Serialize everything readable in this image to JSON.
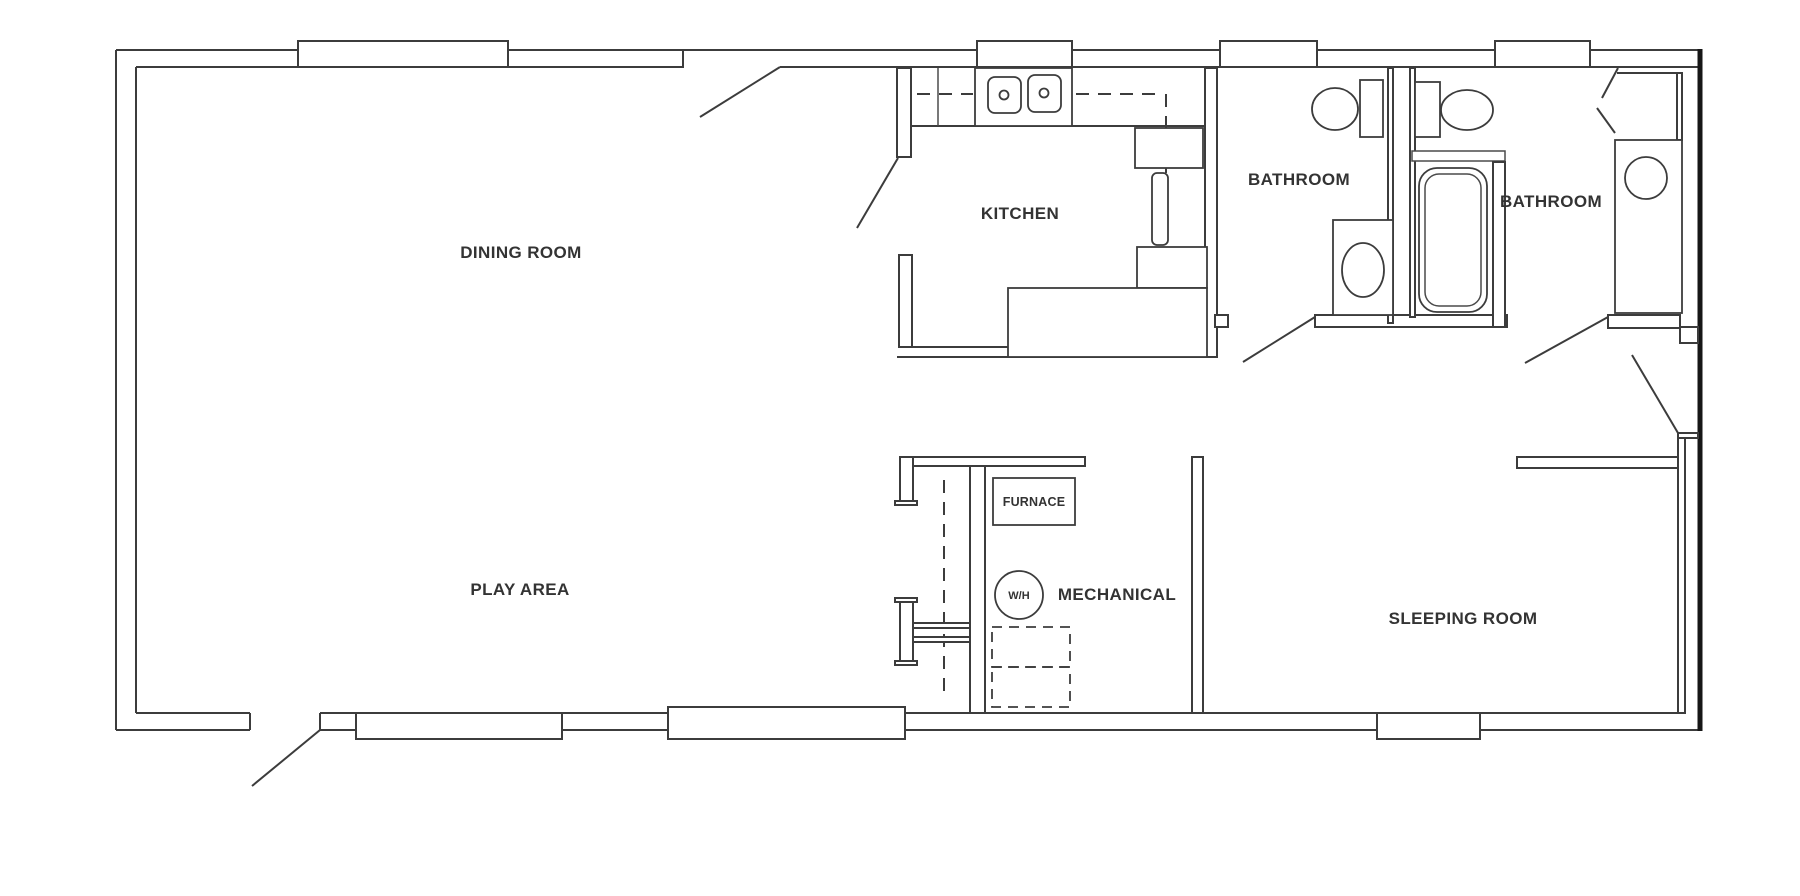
{
  "page": {
    "background": "#ffffff",
    "wall_color": "#3c3c3c",
    "outer_right_wall_color": "#161616",
    "label_color": "#333333"
  },
  "floor_plan": {
    "rooms": [
      {
        "id": "dining-room",
        "label": "DINING ROOM"
      },
      {
        "id": "kitchen",
        "label": "KITCHEN"
      },
      {
        "id": "bathroom-1",
        "label": "BATHROOM"
      },
      {
        "id": "bathroom-2",
        "label": "BATHROOM"
      },
      {
        "id": "play-area",
        "label": "PLAY AREA"
      },
      {
        "id": "mechanical",
        "label": "MECHANICAL"
      },
      {
        "id": "sleeping-room",
        "label": "SLEEPING ROOM"
      }
    ],
    "equipment": [
      {
        "id": "furnace",
        "label": "FURNACE"
      },
      {
        "id": "water-heater",
        "label": "W/H"
      }
    ],
    "fixtures": [
      "double-kitchen-sink",
      "refrigerator",
      "range",
      "oven",
      "island-counter",
      "toilet",
      "vanity-sink",
      "toilet",
      "bathtub",
      "vanity-sink",
      "furnace",
      "water-heater",
      "washer-dryer-dashed"
    ],
    "window_count": 8,
    "door_swing_count": 8
  }
}
